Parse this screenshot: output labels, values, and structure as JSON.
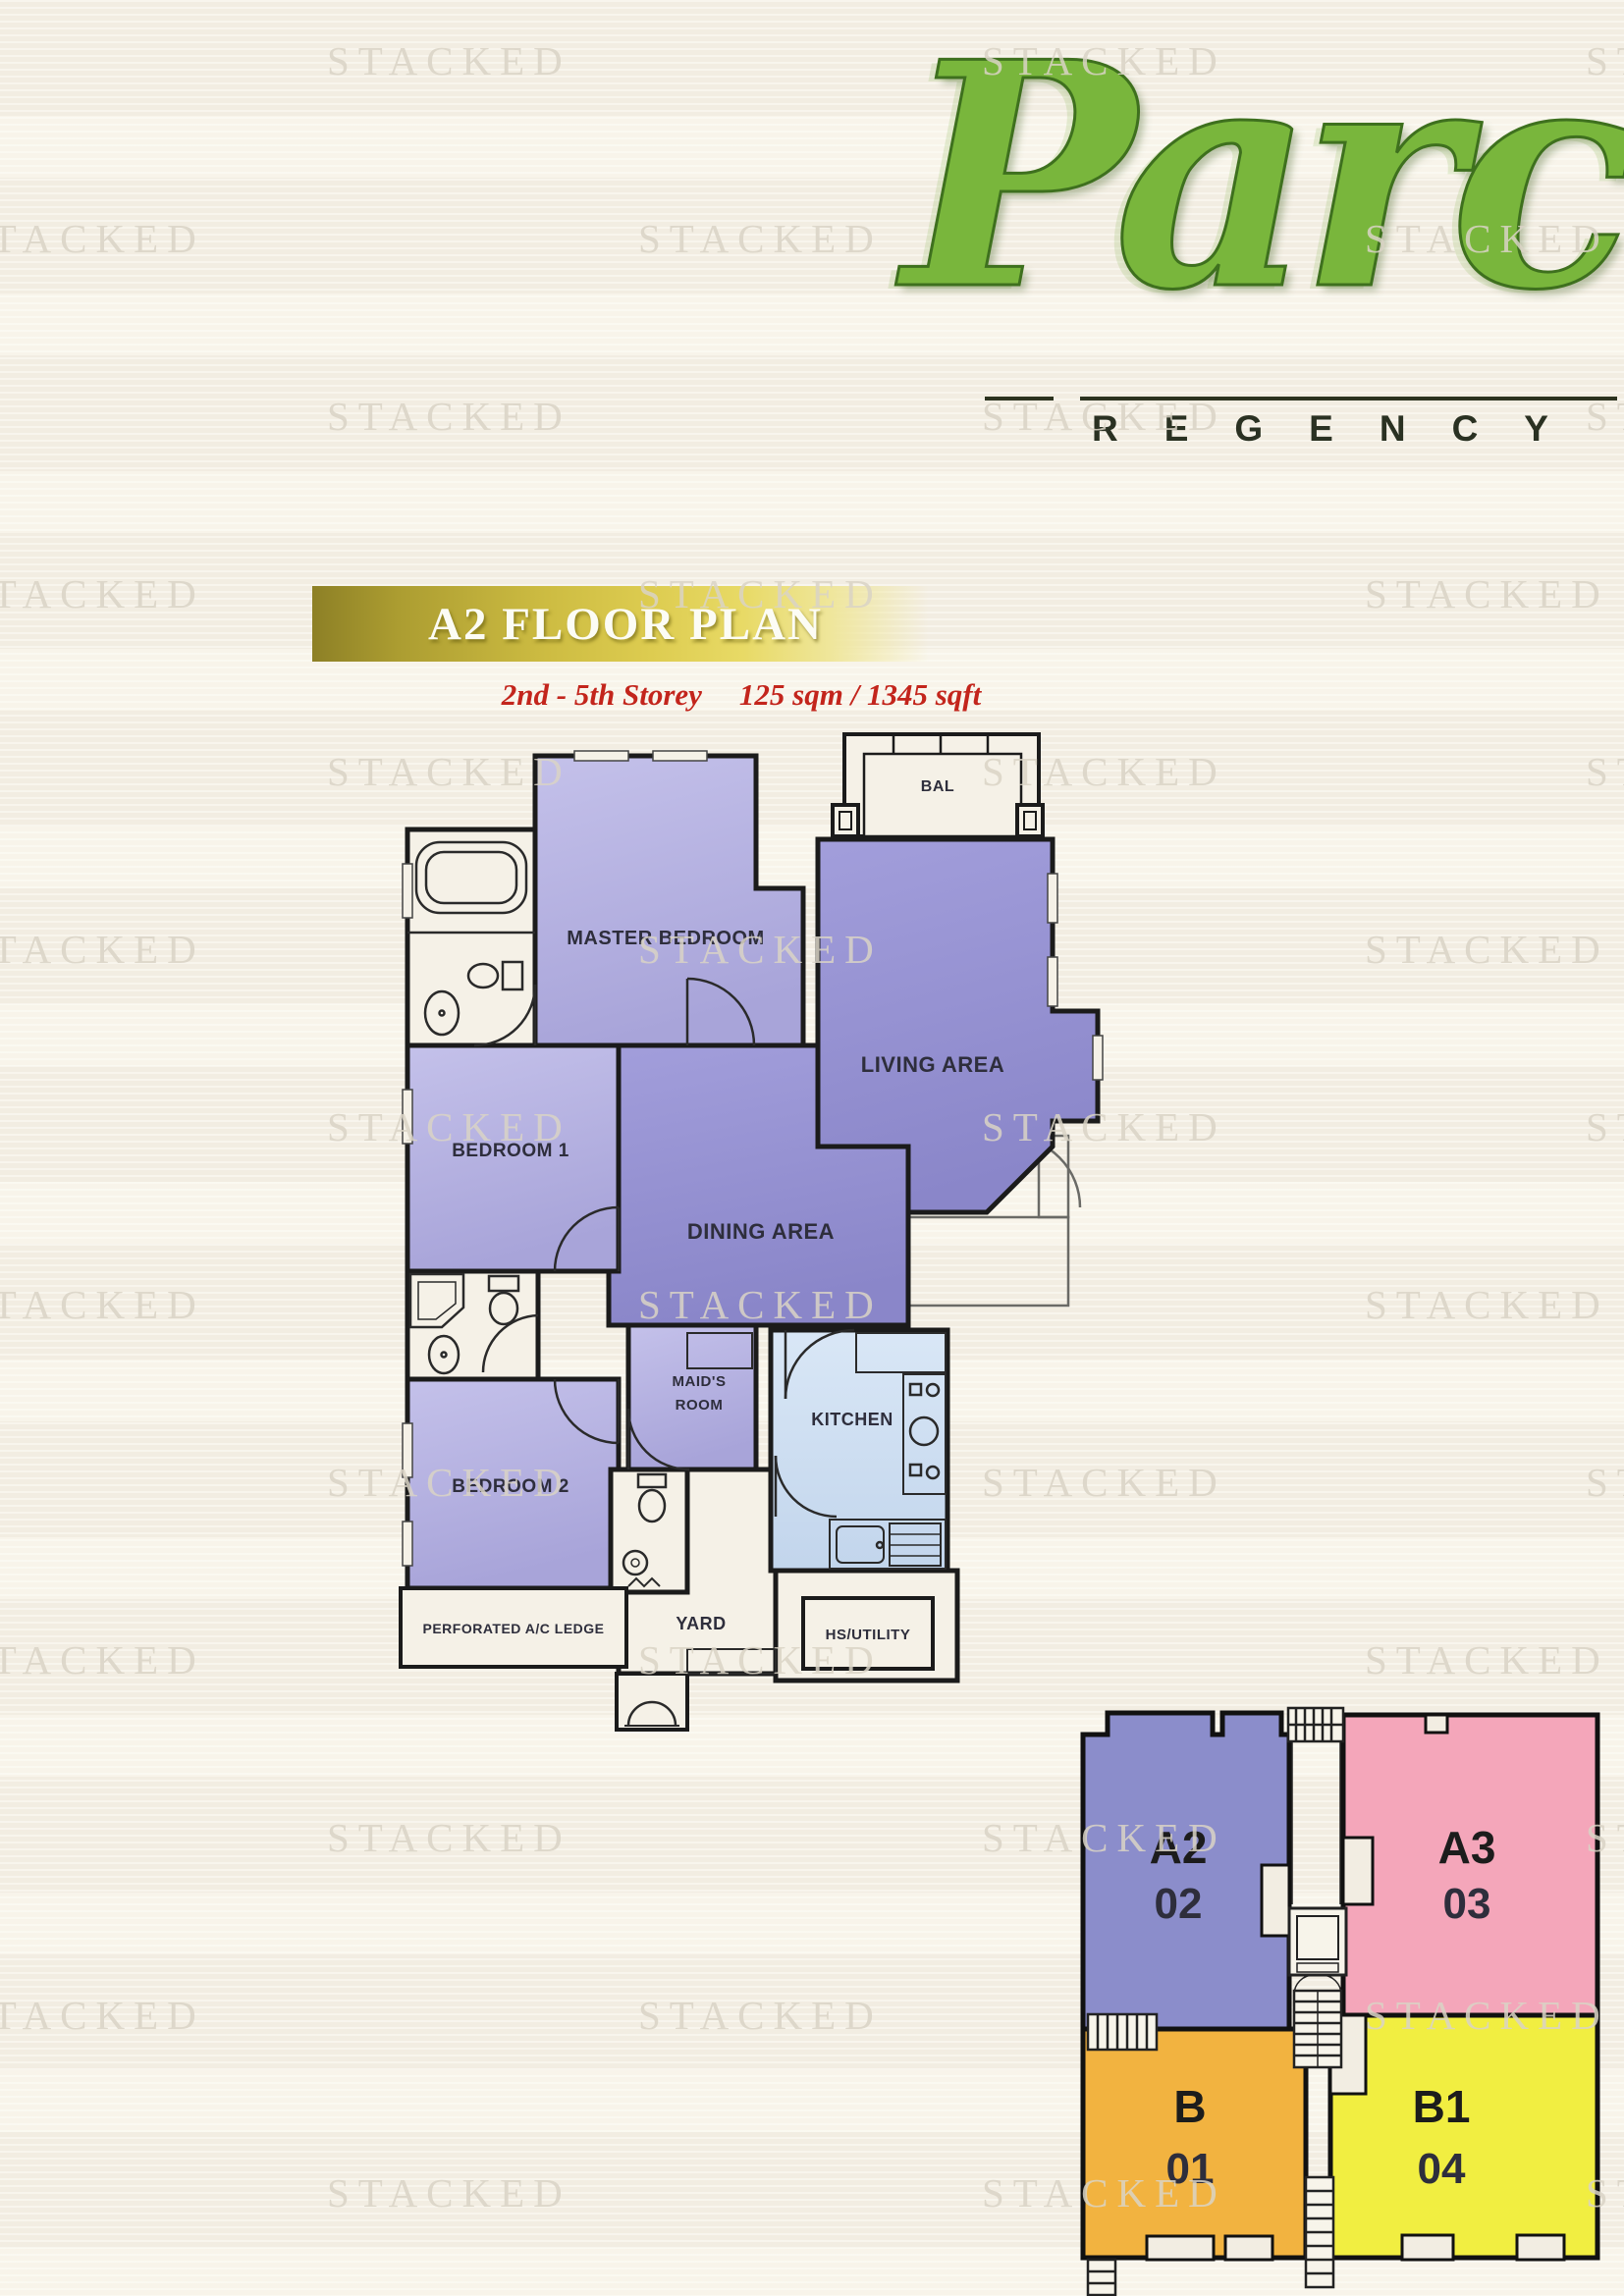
{
  "watermark": {
    "text": "STACKED"
  },
  "logo": {
    "script": "Parc",
    "word": "REGENCY",
    "brand_green": "#79b63c"
  },
  "header": {
    "title": "A2 FLOOR PLAN",
    "storey": "2nd - 5th Storey",
    "area": "125 sqm / 1345 sqft",
    "banner_gold": "#cdbc42",
    "subtitle_red": "#c3251c"
  },
  "floorplan": {
    "rooms": {
      "bal": "BAL",
      "master_bedroom": "MASTER BEDROOM",
      "living": "LIVING AREA",
      "bedroom1": "BEDROOM 1",
      "dining": "DINING AREA",
      "bedroom2": "BEDROOM 2",
      "maids_line1": "MAID'S",
      "maids_line2": "ROOM",
      "kitchen": "KITCHEN",
      "yard": "YARD",
      "hs_utility": "HS/UTILITY",
      "ac_ledge": "PERFORATED A/C LEDGE"
    },
    "colors": {
      "bedroom_lavender": "#b5b2e0",
      "living_purple": "#928ecf",
      "kitchen_blue": "#cfe0f2",
      "wall": "#1b1b1b",
      "paper": "#f5f1e7"
    }
  },
  "keyplan": {
    "units": [
      {
        "code": "A2",
        "number": "02",
        "color": "#8b8dcb"
      },
      {
        "code": "A3",
        "number": "03",
        "color": "#f4a6ba"
      },
      {
        "code": "B",
        "number": "01",
        "color": "#f2b340"
      },
      {
        "code": "B1",
        "number": "04",
        "color": "#f1ee41"
      }
    ],
    "number_color": "#f2362a"
  }
}
